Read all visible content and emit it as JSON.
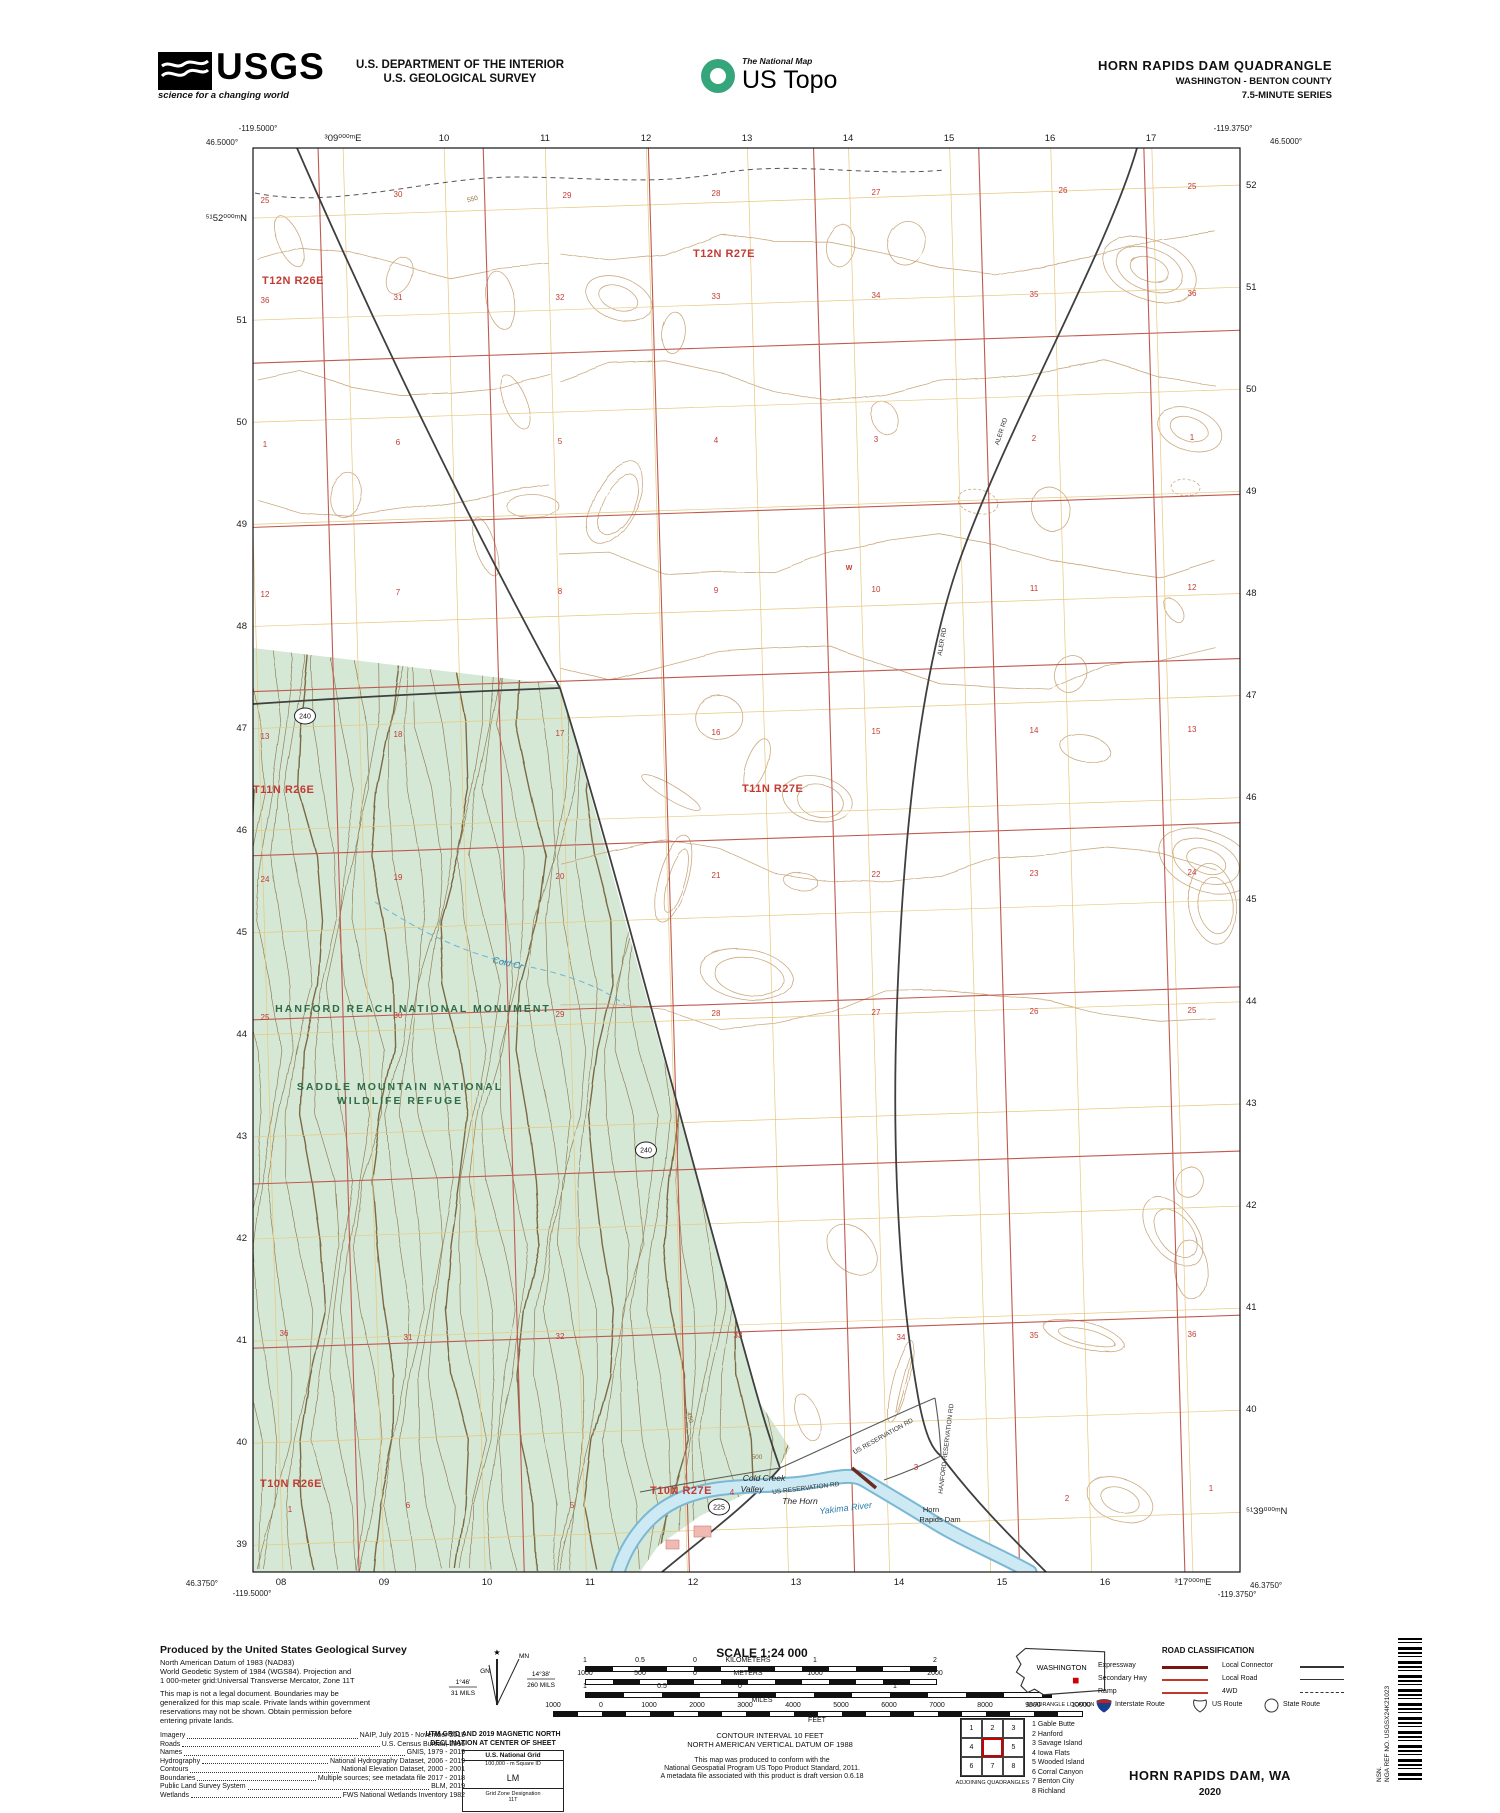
{
  "header": {
    "usgs_logo_text": "USGS",
    "usgs_tagline": "science for a changing world",
    "agency_line1": "U.S. DEPARTMENT OF THE INTERIOR",
    "agency_line2": "U.S. GEOLOGICAL SURVEY",
    "topo_logo_small": "The National Map",
    "topo_logo_large": "US Topo",
    "title_line1": "HORN RAPIDS DAM QUADRANGLE",
    "title_line2": "WASHINGTON - BENTON COUNTY",
    "title_line3": "7.5-MINUTE SERIES"
  },
  "map": {
    "corner_coords": {
      "top_left_lon": "-119.5000°",
      "top_left_lat": "46.5000°",
      "top_right_lon": "-119.3750°",
      "top_right_lat": "46.5000°",
      "bottom_left_lat": "46.3750°",
      "bottom_left_lon": "-119.5000°",
      "bottom_right_lat": "46.3750°",
      "bottom_right_lon": "-119.3750°"
    },
    "grid_top": [
      "³09⁰⁰⁰ᵐE",
      "10",
      "11",
      "12",
      "13",
      "14",
      "15",
      "16",
      "17"
    ],
    "grid_bottom": [
      "08",
      "09",
      "10",
      "11",
      "12",
      "13",
      "14",
      "15",
      "16",
      "³17⁰⁰⁰ᵐE"
    ],
    "grid_left": [
      "⁵¹52⁰⁰⁰ᵐN",
      "51",
      "50",
      "49",
      "48",
      "47",
      "46",
      "45",
      "44",
      "43",
      "42",
      "41",
      "40",
      "39"
    ],
    "grid_right": [
      "52",
      "51",
      "50",
      "49",
      "48",
      "47",
      "46",
      "45",
      "44",
      "43",
      "42",
      "41",
      "40",
      "⁵¹39⁰⁰⁰ᵐN"
    ],
    "townships": [
      [
        "T12N R26E",
        262,
        284
      ],
      [
        "T12N R27E",
        693,
        257
      ],
      [
        "T11N R26E",
        253,
        793
      ],
      [
        "T11N R27E",
        742,
        792
      ],
      [
        "T10N R26E",
        260,
        1487
      ],
      [
        "T10N R27E",
        650,
        1494
      ]
    ],
    "sections": [
      [
        "25",
        265,
        203
      ],
      [
        "30",
        398,
        197
      ],
      [
        "29",
        567,
        198
      ],
      [
        "28",
        716,
        196
      ],
      [
        "27",
        876,
        195
      ],
      [
        "26",
        1063,
        193
      ],
      [
        "25",
        1192,
        189
      ],
      [
        "36",
        265,
        303
      ],
      [
        "31",
        398,
        300
      ],
      [
        "32",
        560,
        300
      ],
      [
        "33",
        716,
        299
      ],
      [
        "34",
        876,
        298
      ],
      [
        "35",
        1034,
        297
      ],
      [
        "36",
        1192,
        296
      ],
      [
        "1",
        265,
        447
      ],
      [
        "6",
        398,
        445
      ],
      [
        "5",
        560,
        444
      ],
      [
        "4",
        716,
        443
      ],
      [
        "3",
        876,
        442
      ],
      [
        "2",
        1034,
        441
      ],
      [
        "1",
        1192,
        440
      ],
      [
        "12",
        265,
        597
      ],
      [
        "7",
        398,
        595
      ],
      [
        "8",
        560,
        594
      ],
      [
        "9",
        716,
        593
      ],
      [
        "10",
        876,
        592
      ],
      [
        "11",
        1034,
        591
      ],
      [
        "12",
        1192,
        590
      ],
      [
        "13",
        265,
        739
      ],
      [
        "18",
        398,
        737
      ],
      [
        "17",
        560,
        736
      ],
      [
        "16",
        716,
        735
      ],
      [
        "15",
        876,
        734
      ],
      [
        "14",
        1034,
        733
      ],
      [
        "13",
        1192,
        732
      ],
      [
        "24",
        265,
        882
      ],
      [
        "19",
        398,
        880
      ],
      [
        "20",
        560,
        879
      ],
      [
        "21",
        716,
        878
      ],
      [
        "22",
        876,
        877
      ],
      [
        "23",
        1034,
        876
      ],
      [
        "24",
        1192,
        875
      ],
      [
        "25",
        265,
        1020
      ],
      [
        "30",
        398,
        1018
      ],
      [
        "29",
        560,
        1017
      ],
      [
        "28",
        716,
        1016
      ],
      [
        "27",
        876,
        1015
      ],
      [
        "26",
        1034,
        1014
      ],
      [
        "25",
        1192,
        1013
      ],
      [
        "36",
        284,
        1336
      ],
      [
        "31",
        408,
        1340
      ],
      [
        "32",
        560,
        1339
      ],
      [
        "33",
        738,
        1338
      ],
      [
        "34",
        901,
        1340
      ],
      [
        "35",
        1034,
        1338
      ],
      [
        "36",
        1192,
        1337
      ],
      [
        "1",
        290,
        1512
      ],
      [
        "6",
        408,
        1508
      ],
      [
        "5",
        572,
        1508
      ],
      [
        "4",
        732,
        1495
      ],
      [
        "3",
        916,
        1470
      ],
      [
        "2",
        1067,
        1501
      ],
      [
        "1",
        1211,
        1491
      ]
    ],
    "places": [
      [
        "HANFORD REACH NATIONAL MONUMENT",
        413,
        1012,
        "fed",
        0
      ],
      [
        "SADDLE MOUNTAIN NATIONAL",
        400,
        1090,
        "fed",
        0
      ],
      [
        "WILDLIFE REFUGE",
        400,
        1104,
        "fed",
        0
      ],
      [
        "Cold Creek",
        764,
        1481,
        "blkit",
        0
      ],
      [
        "Valley",
        752,
        1492,
        "blkit",
        0
      ],
      [
        "The Horn",
        800,
        1504,
        "blkit",
        0
      ],
      [
        "Horn",
        931,
        1512,
        "blk",
        0
      ],
      [
        "Rapids Dam",
        940,
        1522,
        "blk",
        0
      ],
      [
        "US RESERVATION RD",
        806,
        1490,
        "road",
        -7
      ],
      [
        "US RESERVATION RD",
        884,
        1438,
        "road",
        -29
      ],
      [
        "HANFORD RESERVATION RD",
        948,
        1449,
        "road",
        -83
      ],
      [
        "ALER RD",
        1003,
        432,
        "road",
        -72
      ],
      [
        "ALER RD",
        944,
        642,
        "road",
        -80
      ],
      [
        "Cold Cr",
        507,
        966,
        "blueit",
        13
      ],
      [
        "Cold Cr",
        243,
        702,
        "blueit",
        80
      ],
      [
        "Yakima River",
        846,
        1511,
        "blueit",
        -7
      ],
      [
        "W",
        849,
        570,
        "well",
        0
      ]
    ],
    "shields": [
      [
        "240",
        305,
        716
      ],
      [
        "240",
        646,
        1150
      ],
      [
        "225",
        719,
        1507
      ]
    ],
    "contour_labels": [
      [
        "550",
        473,
        201,
        -15
      ],
      [
        "450",
        688,
        1418,
        75
      ],
      [
        "500",
        757,
        1459,
        0
      ]
    ]
  },
  "footer": {
    "produced_title": "Produced by the United States Geological Survey",
    "produced_lines": [
      "North American Datum of 1983 (NAD83)",
      "World Geodetic System of 1984 (WGS84).  Projection and",
      "1 000-meter grid:Universal Transverse Mercator, Zone 11T"
    ],
    "legal_lines": [
      "This map is not a legal document. Boundaries may be",
      "generalized for this map scale. Private lands within government",
      "reservations may not be shown. Obtain permission before",
      "entering private lands."
    ],
    "credits": [
      [
        "Imagery",
        "NAIP, July 2015 - November 2015"
      ],
      [
        "Roads",
        "U.S. Census Bureau, 2016"
      ],
      [
        "Names",
        "GNIS, 1979 - 2019"
      ],
      [
        "Hydrography",
        "National Hydrography Dataset, 2006 - 2019"
      ],
      [
        "Contours",
        "National Elevation Dataset, 2000 - 2001"
      ],
      [
        "Boundaries",
        "Multiple sources; see metadata file 2017 - 2018"
      ],
      [
        "Public Land Survey System",
        "BLM, 2019"
      ],
      [
        "Wetlands",
        "FWS National Wetlands Inventory 1982"
      ]
    ],
    "declination": {
      "gn_label": "GN",
      "mn_label": "MN",
      "gn_deg": "1°46'",
      "gn_mils": "31 MILS",
      "mn_deg": "14°38'",
      "mn_mils": "260 MILS",
      "caption1": "UTM GRID AND 2019 MAGNETIC NORTH",
      "caption2": "DECLINATION AT CENTER OF SHEET"
    },
    "usng": {
      "title": "U.S. National Grid",
      "sub": "100,000 - m Square ID",
      "square": "LM",
      "zone_label": "Grid Zone Designation",
      "zone": "11T"
    },
    "scale": {
      "title": "SCALE 1:24 000",
      "km_labels": [
        "1",
        "0.5",
        "0",
        "KILOMETERS",
        "1",
        "2"
      ],
      "m_labels": [
        "1000",
        "500",
        "0",
        "METERS",
        "1000",
        "2000"
      ],
      "mi_labels": [
        "1",
        "0.5",
        "0",
        "1"
      ],
      "mi_unit": "MILES",
      "ft_labels": [
        "1000",
        "0",
        "1000",
        "2000",
        "3000",
        "4000",
        "5000",
        "6000",
        "7000",
        "8000",
        "9000",
        "10000"
      ],
      "ft_unit": "FEET"
    },
    "contour_note": "CONTOUR INTERVAL 10 FEET",
    "datum_note": "NORTH AMERICAN VERTICAL DATUM OF 1988",
    "conform_lines": [
      "This map was produced to conform with the",
      "National Geospatial Program US Topo Product Standard, 2011.",
      "A metadata file associated with this product is draft version 0.6.18"
    ],
    "location": {
      "state": "WASHINGTON",
      "caption": "QUADRANGLE LOCATION"
    },
    "adjoining": {
      "cells": [
        "1",
        "2",
        "3",
        "4",
        "5",
        "6",
        "7",
        "8"
      ],
      "names": [
        "1 Gable Butte",
        "2 Hanford",
        "3 Savage Island",
        "4 Iowa Flats",
        "5 Wooded Island",
        "6 Corral Canyon",
        "7 Benton City",
        "8 Richland"
      ],
      "caption": "ADJOINING QUADRANGLES"
    },
    "road_class": {
      "title": "ROAD CLASSIFICATION",
      "left": [
        "Expressway",
        "Secondary Hwy",
        "Ramp"
      ],
      "right": [
        "Local Connector",
        "Local Road",
        "4WD"
      ],
      "shields": [
        "Interstate Route",
        "US Route",
        "State Route"
      ]
    },
    "sheet_title": "HORN RAPIDS DAM,  WA",
    "sheet_year": "2020",
    "sidebar": {
      "nsn": "NSN.",
      "nga": "NGA REF NO. USGSX24K21023"
    }
  }
}
